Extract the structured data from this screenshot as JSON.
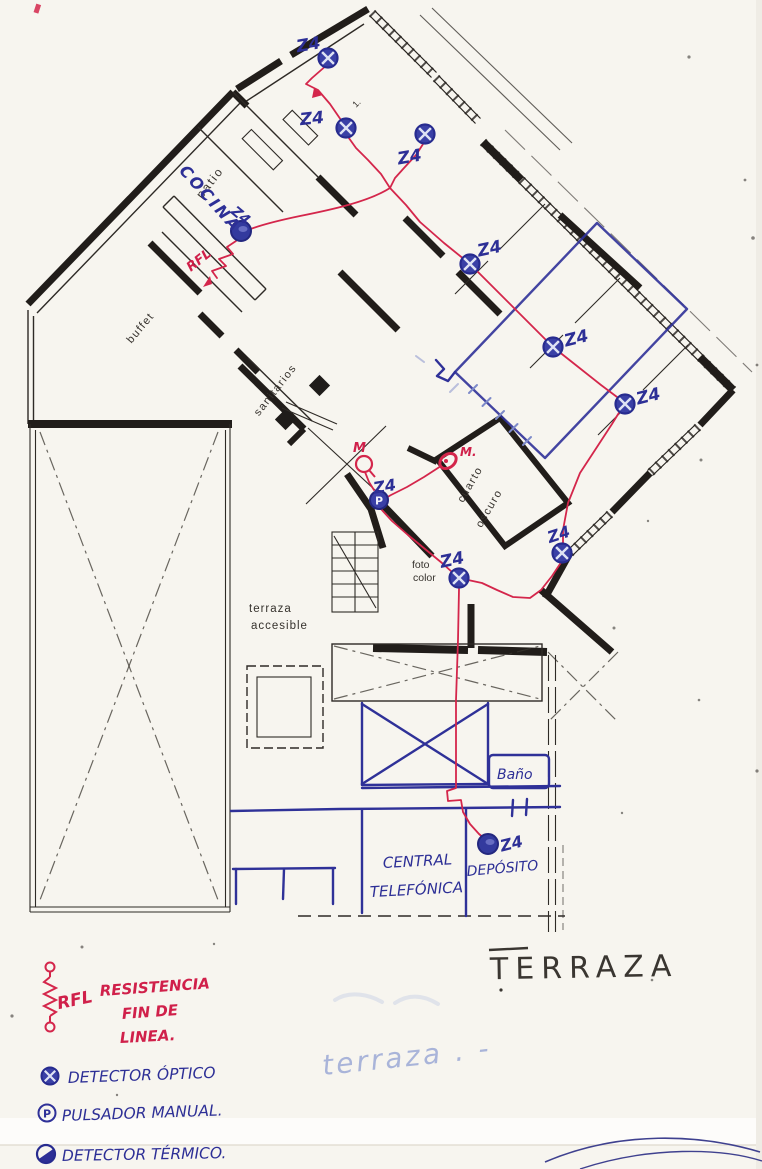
{
  "colors": {
    "paper": "#f7f5ef",
    "print_black": "#2a2622",
    "red_ink": "#d4264b",
    "blue_ink": "#2f3198",
    "faint_blue": "#9fafdb"
  },
  "plan": {
    "printed": {
      "patio": "patio",
      "buffet": "buffet",
      "sanitarios": "sanitarios",
      "cuarto_oscuro": [
        "cuarto",
        "oscuro"
      ],
      "foto_color": [
        "foto",
        "color"
      ],
      "terraza_accesible": [
        "terraza",
        "accesible"
      ],
      "mark": "1."
    },
    "hand": {
      "cocina": "COCINA",
      "rfl": "RFL",
      "bano": "Baño",
      "central": [
        "CENTRAL",
        "TELEFÓNICA"
      ],
      "deposito": "DEPÓSITO",
      "terraza": "TERRAZA",
      "terraza_faint": "terraza . -",
      "m1": "M",
      "m2": "M."
    },
    "detectors": [
      {
        "area": "top-room",
        "label": "Z4"
      },
      {
        "area": "patio-hall",
        "label": "Z4"
      },
      {
        "area": "hall",
        "label": "Z4"
      },
      {
        "area": "cocina",
        "label": "Z4"
      },
      {
        "area": "living-1",
        "label": "Z4"
      },
      {
        "area": "living-2",
        "label": "Z4"
      },
      {
        "area": "living-3",
        "label": "Z4"
      },
      {
        "area": "foto-color",
        "label": "Z4"
      },
      {
        "area": "cuarto-oscuro",
        "label": "Z4"
      },
      {
        "area": "deposito",
        "label": "Z4"
      }
    ],
    "pulsador": {
      "letter": "P",
      "label": "Z4"
    }
  },
  "legend": {
    "items": [
      {
        "symbol": "rfl-resistor",
        "abbr": "RFL",
        "lines": [
          "RESISTENCIA",
          "FIN DE",
          "LINEA."
        ]
      },
      {
        "symbol": "optical-detector",
        "label": "DETECTOR ÓPTICO"
      },
      {
        "symbol": "manual-pushbutton",
        "label": "PULSADOR MANUAL."
      },
      {
        "symbol": "thermal-detector",
        "label": "DETECTOR TÉRMICO."
      }
    ]
  }
}
